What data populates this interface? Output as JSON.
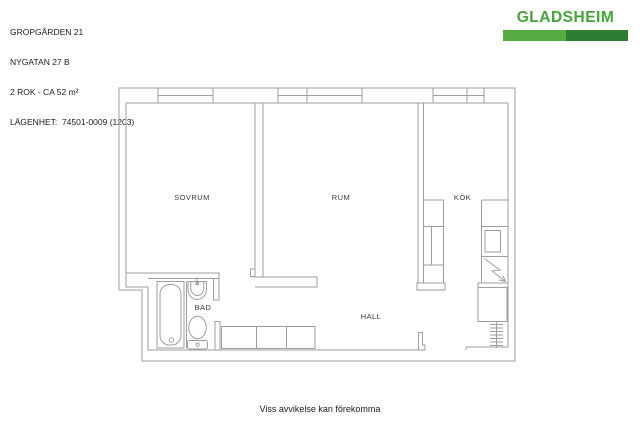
{
  "page": {
    "background_color": "#ffffff",
    "footer_note": "Viss avvikelse kan förekomma"
  },
  "header": {
    "property_name": "GROPGÅRDEN 21",
    "address": "NYGATAN 27 B",
    "rooms_area": "2 ROK - CA 52 m²",
    "apartment_number": "LÄGENHET:  74501-0009 (1203)"
  },
  "logo": {
    "brand": "GLADSHEIM",
    "text_color": "#45A23A",
    "bar_left_color": "#56AC41",
    "bar_right_color": "#2E7D32"
  },
  "floorplan": {
    "line_color": "#9E9E9E",
    "label_color": "#3a3a3a",
    "rooms": {
      "sovrum": {
        "label": "SOVRUM"
      },
      "rum": {
        "label": "RUM"
      },
      "kok": {
        "label": "KÖK"
      },
      "bad": {
        "label": "BAD"
      },
      "hall": {
        "label": "HALL"
      }
    },
    "fixtures": [
      "windows",
      "bathtub",
      "bathroom-sink",
      "toilet",
      "kitchen-counter-left",
      "kitchen-counter-right",
      "kitchen-sink",
      "stove",
      "closet",
      "radiator",
      "hall-wardrobe",
      "entrance-door-jamb"
    ]
  }
}
